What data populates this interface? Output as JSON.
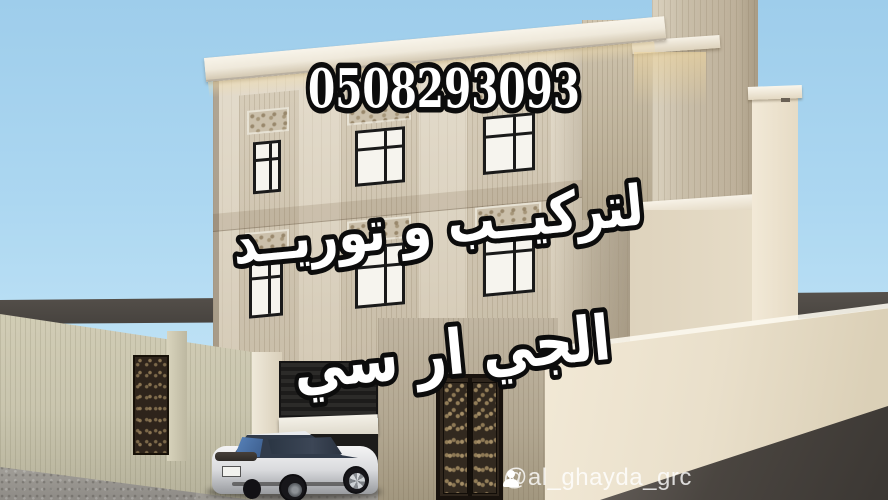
{
  "overlay": {
    "phone_number": "0508293093",
    "headline_line1": "لتركيــب و توريــد",
    "headline_line2": "الجي ار سي"
  },
  "watermark": {
    "music_note_icon": "♪",
    "handle": "@al_ghayda_grc"
  },
  "palette": {
    "sky_top": "#9ecdeb",
    "sky_bottom": "#bde1f5",
    "facade_light": "#dbd2c0",
    "facade_mid": "#c8bda8",
    "cornice": "#efe9db",
    "tower": "#c9bea9",
    "left_wall": "#c9c5ae",
    "right_wall": "#e9dfca",
    "shadow_wall": "#b2a791",
    "ground_gray": "#9e9b95",
    "road_dark": "#46423e",
    "window_frame": "#1a1a1a",
    "glass_white": "#f6f4ee",
    "door_dark": "#2e251c",
    "car_body": "#d9dadd",
    "car_glass_blue": "#5b87c0",
    "text_fill": "#ffffff",
    "text_outline": "#0c0c0c",
    "watermark_color": "#ffffff"
  }
}
